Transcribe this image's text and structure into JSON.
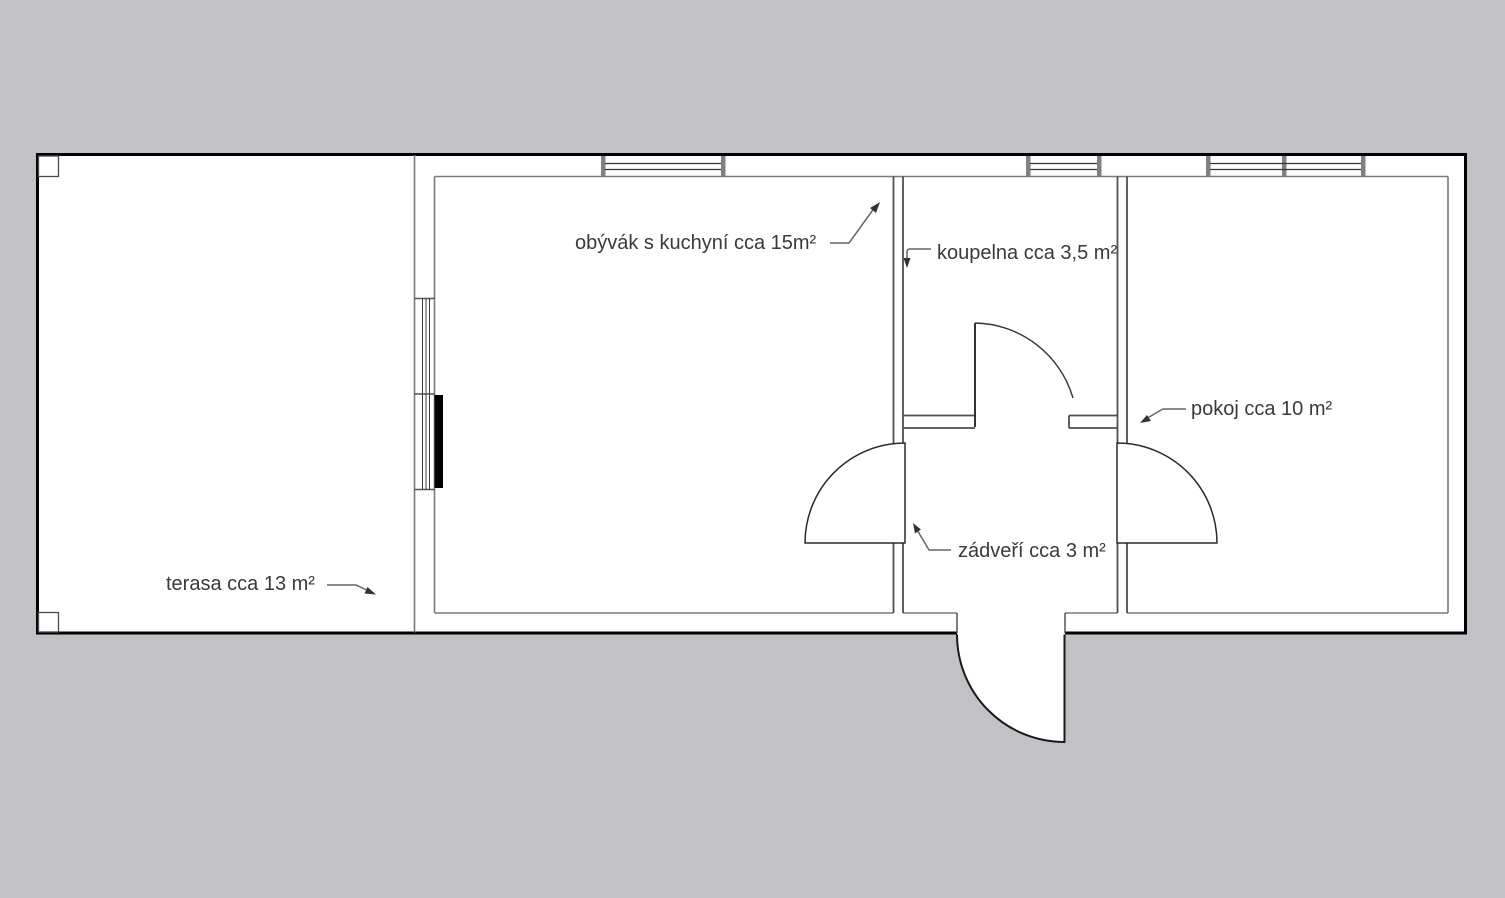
{
  "plan_title": "floor plan",
  "rooms": [
    {
      "id": "living-room",
      "label": "obývák s kuchyní cca 15m²",
      "name": "obývák s kuchyní",
      "area": "cca 15m²"
    },
    {
      "id": "bathroom",
      "label": "koupelna cca 3,5 m²",
      "name": "koupelna",
      "area": "cca 3,5 m²"
    },
    {
      "id": "room",
      "label": "pokoj cca 10 m²",
      "name": "pokoj",
      "area": "cca 10 m²"
    },
    {
      "id": "vestibule",
      "label": "zádveří cca 3 m²",
      "name": "zádveří",
      "area": "cca 3 m²"
    },
    {
      "id": "terrace",
      "label": "terasa cca 13 m²",
      "name": "terasa",
      "area": "cca 13 m²"
    }
  ],
  "colors": {
    "background": "#c1c1c6",
    "plan_fill": "#ffffff",
    "outer_wall_line": "#000000",
    "inner_wall_line": "#4f4f4f",
    "face_line": "#7a7a7a",
    "window_post": "#808080",
    "door_leaf_fill": "#000000",
    "leader_line": "#666666",
    "label_text": "#3a3a3a"
  }
}
